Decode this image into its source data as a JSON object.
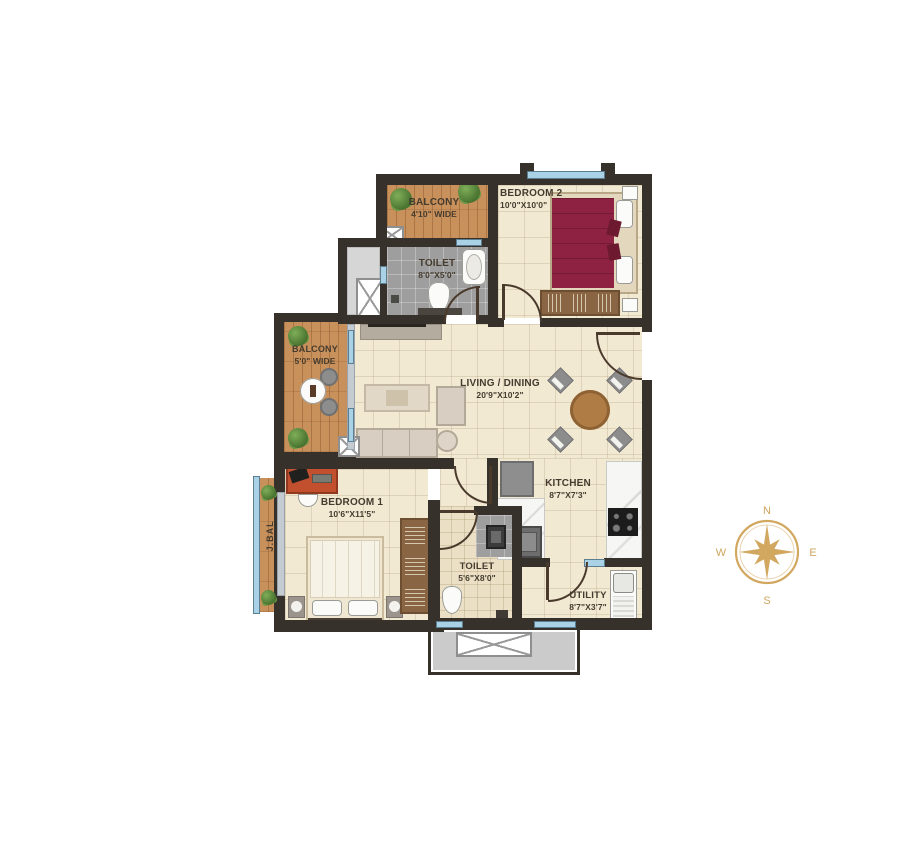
{
  "plan": {
    "rooms": {
      "balcony_top": {
        "name": "BALCONY",
        "size": "4'10\" WIDE"
      },
      "bedroom2": {
        "name": "BEDROOM 2",
        "size": "10'0\"X10'0\""
      },
      "toilet_top": {
        "name": "TOILET",
        "size": "8'0\"X5'0\""
      },
      "balcony_left": {
        "name": "BALCONY",
        "size": "5'0\" WIDE"
      },
      "living_dining": {
        "name": "LIVING / DINING",
        "size": "20'9\"X10'2\""
      },
      "kitchen": {
        "name": "KITCHEN",
        "size": "8'7\"X7'3\""
      },
      "bedroom1": {
        "name": "BEDROOM 1",
        "size": "10'6\"X11'5\""
      },
      "toilet_bottom": {
        "name": "TOILET",
        "size": "5'6\"X8'0\""
      },
      "utility": {
        "name": "UTILITY",
        "size": "8'7\"X3'7\""
      },
      "juliet_balcony": {
        "name": "J.BAL"
      }
    },
    "compass": {
      "north": "N",
      "south": "S",
      "east": "E",
      "west": "W"
    },
    "colors": {
      "wall": "#37312b",
      "wood": "#c8905a",
      "floor_cream": "#f2e9d3",
      "toilet_gray": "#9e9e9e",
      "window_blue": "#a9d2e6",
      "bed_maroon": "#8e2242",
      "compass_gold": "#d2a860"
    }
  }
}
